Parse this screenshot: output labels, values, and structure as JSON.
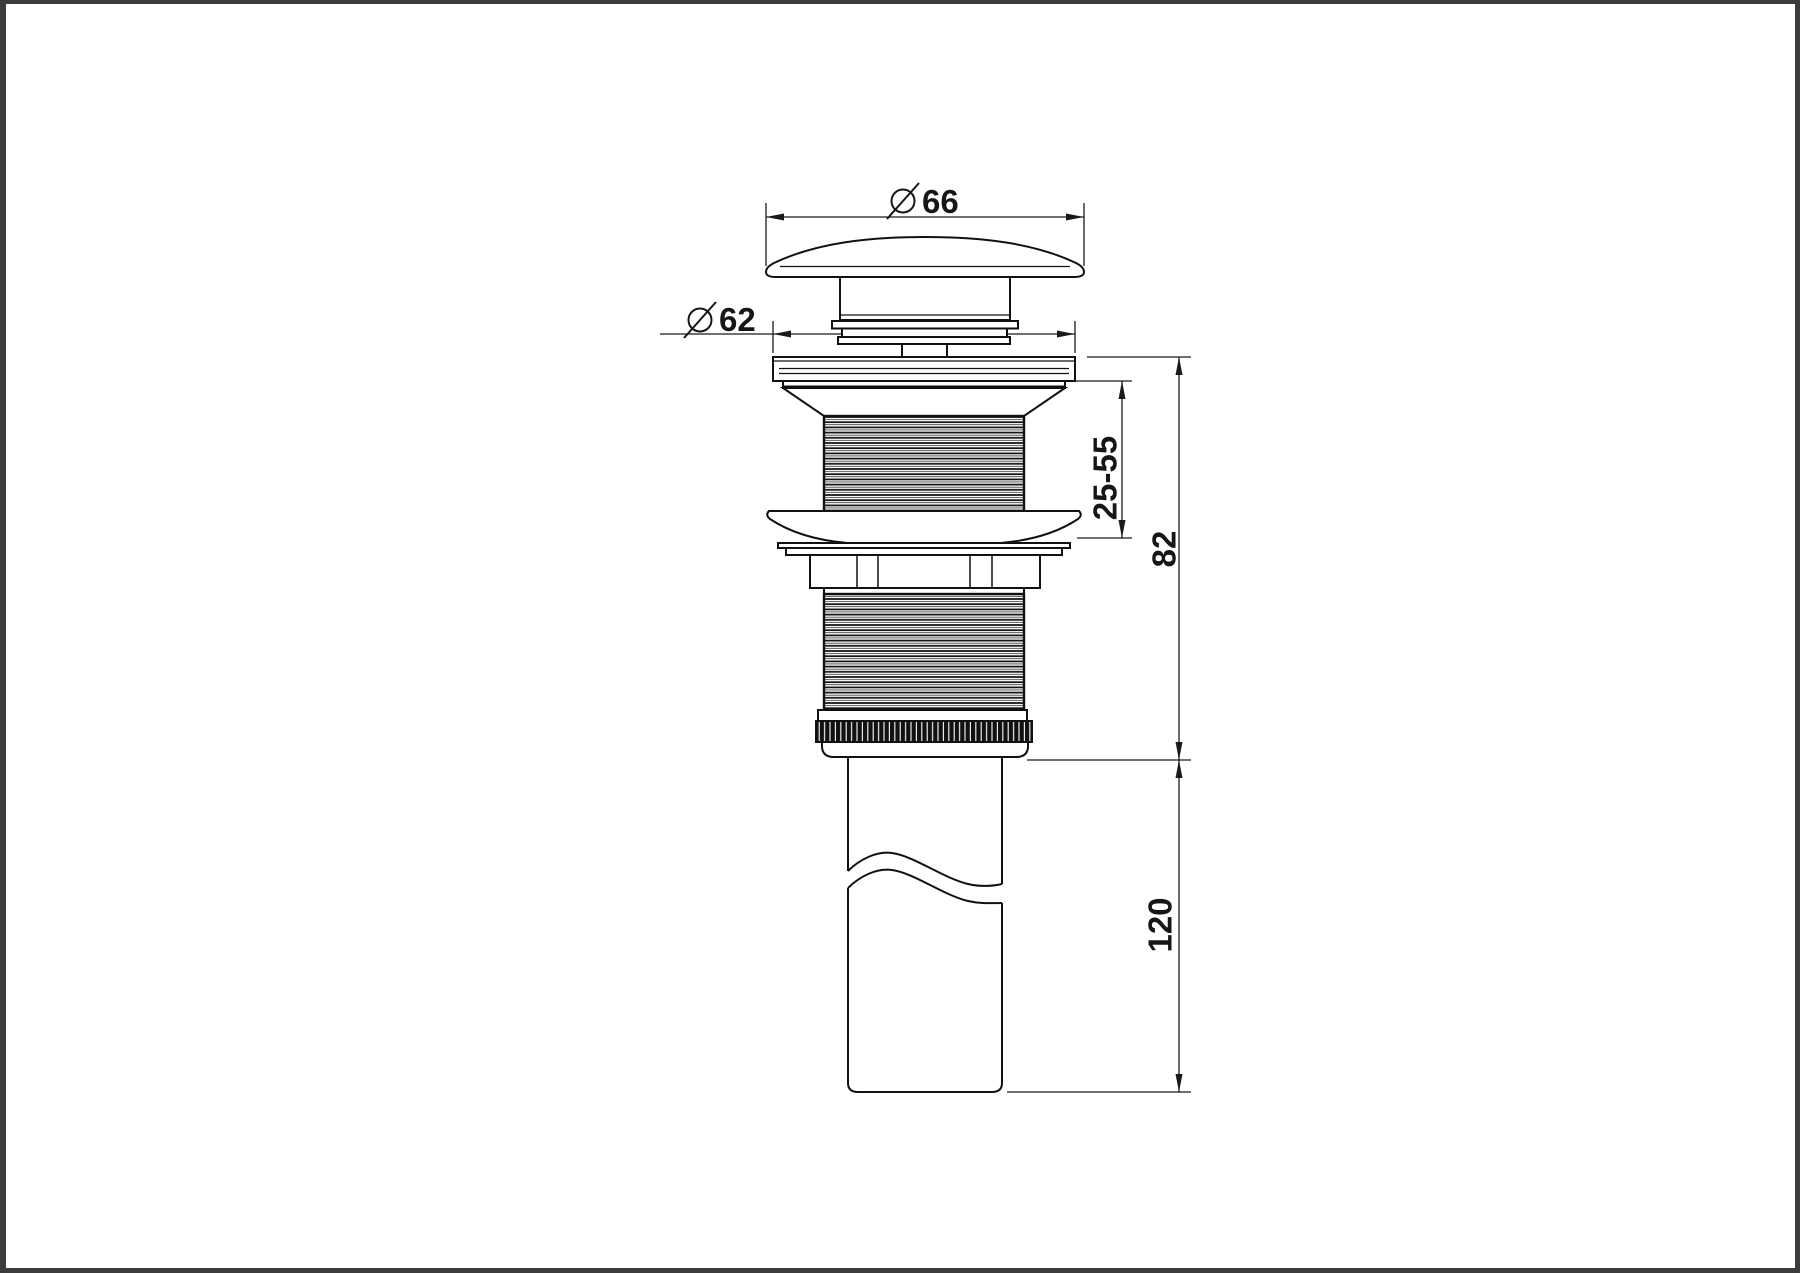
{
  "drawing": {
    "description": "pop-up basin waste side elevation",
    "colors": {
      "line": "#1a1a1a",
      "body_outline": "#111111",
      "background": "#ffffff",
      "frame_border": "#3c3c3c",
      "knurl_fill": "#111111"
    },
    "dimensions": {
      "cap_diameter": {
        "symbol": "diameter",
        "value": "66"
      },
      "flange_diameter": {
        "symbol": "diameter",
        "value": "62"
      },
      "clamp_range": {
        "value": "25-55"
      },
      "body_height": {
        "value": "82"
      },
      "tail_length": {
        "value": "120"
      }
    }
  }
}
